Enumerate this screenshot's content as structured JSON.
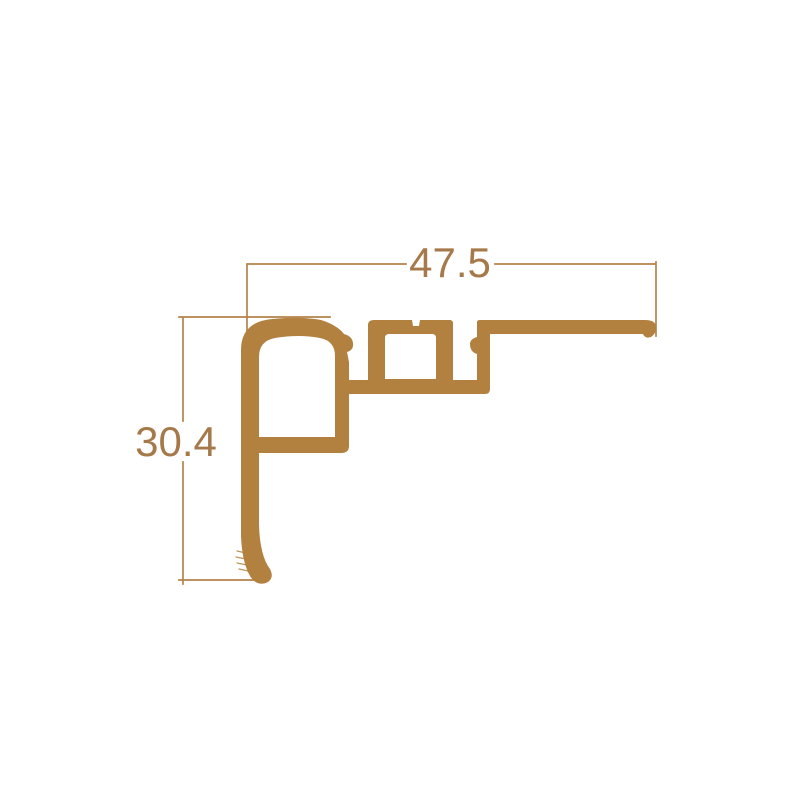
{
  "drawing": {
    "dimensions": {
      "width": "47.5",
      "height": "30.4"
    },
    "colors": {
      "profile": "#b3813f",
      "dimension_lines": "#b5834a",
      "dimension_text": "#a6794a",
      "background": "#ffffff"
    }
  }
}
